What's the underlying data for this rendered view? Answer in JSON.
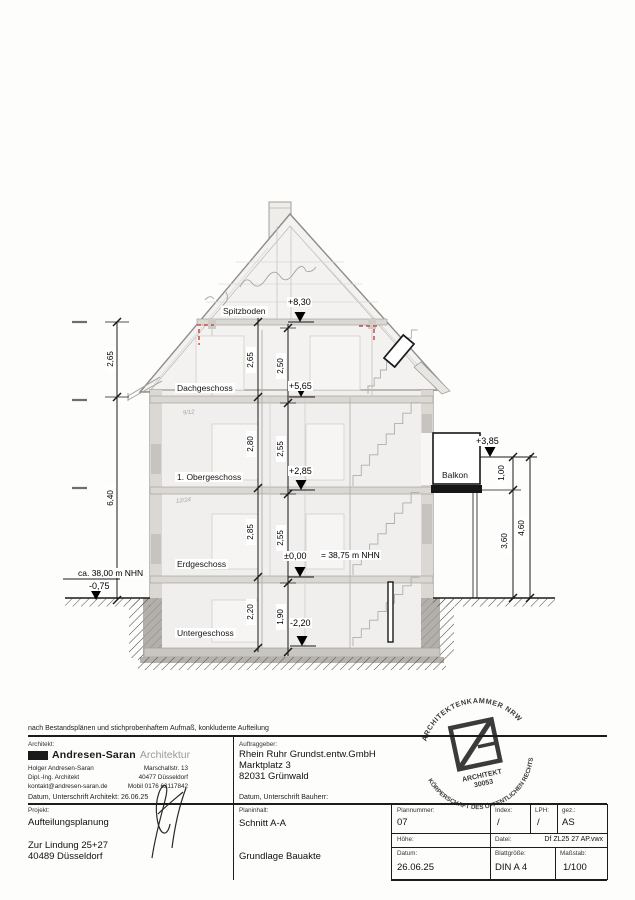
{
  "page": {
    "note": "nach Bestandsplänen und stichprobenhaftem Aufmaß, konkludente Aufteilung"
  },
  "drawing": {
    "floor_labels": [
      "Spitzboden",
      "Dachgeschoss",
      "1. Obergeschoss",
      "Erdgeschoss",
      "Untergeschoss"
    ],
    "balcony_label": "Balkon",
    "elevations": {
      "spitzboden": "+8,30",
      "dachgeschoss": "+5,65",
      "obergeschoss": "+2,85",
      "erdgeschoss": "±0,00",
      "erdgeschoss_eq": "= 38,75 m NHN",
      "untergeschoss": "-2,20",
      "balkon": "+3,85",
      "gelaende": "-0,75",
      "gelaende_note": "ca. 38,00 m NHN"
    },
    "dims_outer": [
      "2,65",
      "6,40"
    ],
    "dims_floor_chain": [
      "2,65",
      "2,80",
      "2,85",
      "2,20"
    ],
    "dims_clear_chain": [
      "2,50",
      "2,55",
      "2,55",
      "1,90"
    ],
    "dims_balcony": [
      "1,00",
      "3,60",
      "4,60"
    ],
    "pencil_marks": [
      "9/12",
      "12/24"
    ]
  },
  "titleblock": {
    "architect": {
      "label": "Architekt:",
      "firm_bold": "Andresen-Saran",
      "firm_light": "Architektur",
      "name": "Holger Andresen-Saran",
      "title": "Dipl.-Ing. Architekt",
      "email": "kontakt@andresen-saran.de",
      "street": "Marschallstr. 13",
      "city": "40477 Düsseldorf",
      "phone": "Mobil 0176 62117842",
      "signature_label": "Datum, Unterschrift Architekt: 26.06.25"
    },
    "client": {
      "label": "Auftraggeber:",
      "name": "Rhein Ruhr Grundst.entw.GmbH",
      "street": "Marktplatz 3",
      "city": "82031 Grünwald",
      "signature_label": "Datum, Unterschrift Bauherr:"
    },
    "project": {
      "label": "Projekt:",
      "name": "Aufteilungsplanung",
      "street": "Zur Lindung 25+27",
      "city": "40489 Düsseldorf"
    },
    "content": {
      "label": "Planinhalt:",
      "name": "Schnitt A-A",
      "basis": "Grundlage Bauakte"
    },
    "grid": {
      "plannummer_label": "Plannummer:",
      "plannummer": "07",
      "index_label": "Index:",
      "index": "/",
      "lph_label": "LPH:",
      "lph": "/",
      "gez_label": "gez.:",
      "gez": "AS",
      "hoehe_label": "Höhe:",
      "datei_label": "Datei:",
      "datei": "Df ZL25 27 AP.vwx",
      "datum_label": "Datum:",
      "datum": "26.06.25",
      "blatt_label": "Blattgröße:",
      "blatt": "DIN A 4",
      "massstab_label": "Maßstab:",
      "massstab": "1/100"
    },
    "stamp": {
      "arc_top": "ARCHITEKTENKAMMER NRW",
      "arc_bottom": "KÖRPERSCHAFT DES ÖFFENTLICHEN RECHTS",
      "center_line1": "ARCHITEKT",
      "center_line2": "30053"
    }
  }
}
